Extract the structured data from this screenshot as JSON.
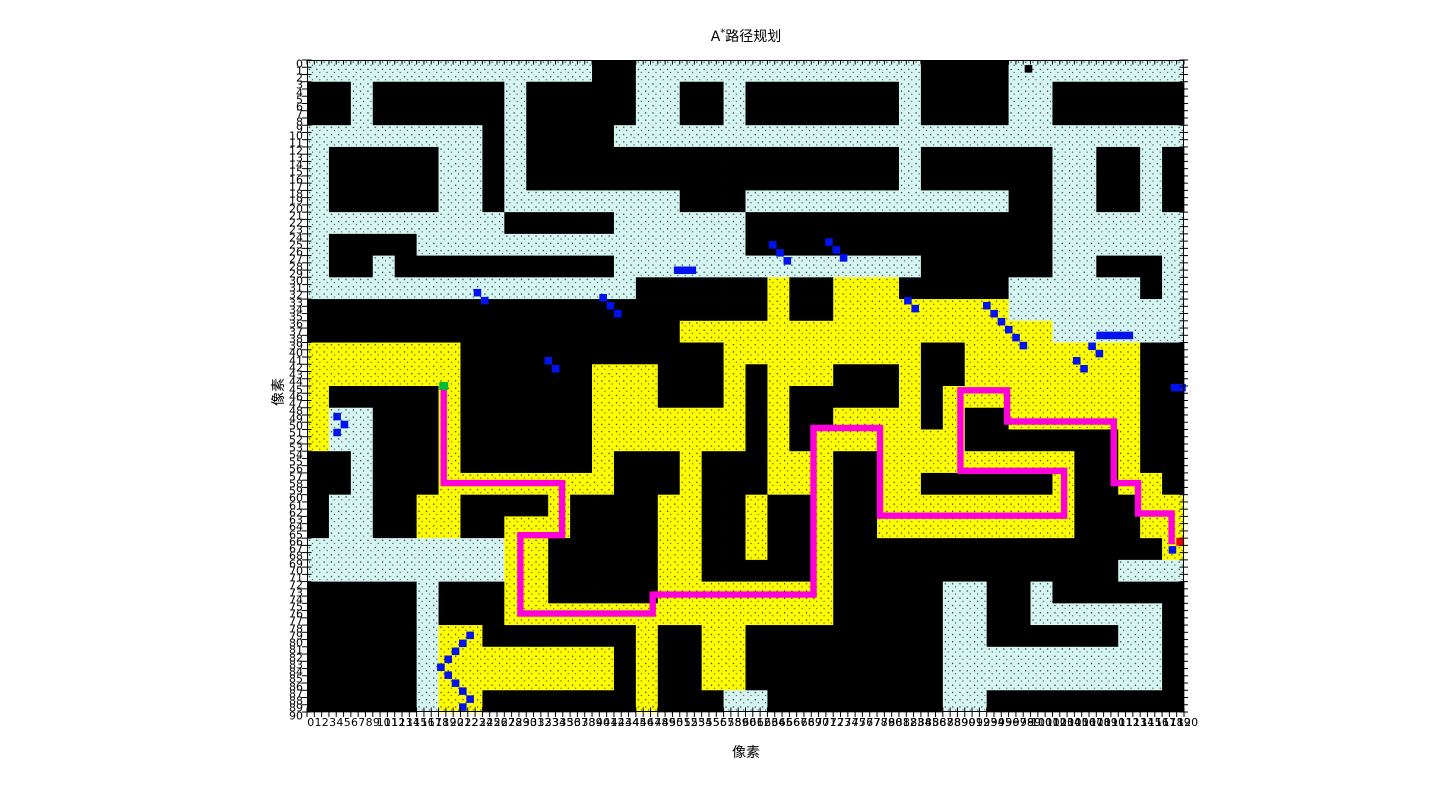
{
  "figure": {
    "title": {
      "prefix": "A",
      "sup": "*",
      "rest": "路径规划"
    },
    "x_axis_label": "像素",
    "y_axis_label": "像素"
  },
  "axes": {
    "x_min": 0,
    "x_max": 120,
    "x_step": 1,
    "y_min": 0,
    "y_max": 90,
    "y_step": 1
  },
  "chart_data": {
    "type": "heatmap",
    "title": "A*路径规划",
    "xlabel": "像素",
    "ylabel": "像素",
    "x_range": [
      0,
      120
    ],
    "y_range": [
      0,
      90
    ],
    "grid_cols": 120,
    "grid_rows": 90,
    "block_size_cells": 3,
    "cell_types": {
      "#": "obstacle",
      ".": "free-space",
      "Y": "explored-closed-set"
    },
    "colors": {
      "obstacle": "#000000",
      "free": "#d6f6f3",
      "explored": "#ffff00",
      "frontier": "#0013ee",
      "path": "#ff00dd",
      "start": "#00bb33",
      "goal": "#ee0000",
      "background": "#ffffff",
      "dot": "#1a1a1a"
    },
    "block_rows": [
      ".............##.............####........",
      "##.######.#####..##.#######.####..######",
      "##.######.#####..##.#######.####..######",
      "........#.####..........................",
      ".#####..#.#################.######..##.#",
      ".#####..#.#################.######..##.#",
      ".#####..#........###............##..##.#",
      ".........#####......##############......",
      ".####...............##############......",
      ".##.##########..............######..###.",
      "...............######Y##YYY#####......#.",
      "#####################Y##YYYYYYYY........",
      "#################YYYYYYYYYYYYYYYYY......",
      "YYYYYYY############YYYYYYYYY##YYYYYYYY##",
      "YYYYYYY######YYY###Y#YYY###Y##YYYYYYYY##",
      "Y#####Y######YYY###Y#Y#####Y#YYYYYYYYY##",
      "Y..###Y######YYYYYYY#Y##YYYY#Y##YYYYYY##",
      "Y..###Y######YYYYYYY#Y#YYYYYYY#######Y##",
      "##.###Y######Y###Y###YYY##YYYYYYYYY##Y##",
      "##.###YYYYYYYY###Y###YYY##YY######Y##YY#",
      "#..##YY####Y####YY##Y##Y##YYYYYYYYY###YY",
      "#..##YY##YYY####YY##Y##Y##YYYYYYYYY###YY",
      ".........YY#####YY##Y##Y###############Y",
      ".........YY#####YY#####Y#############...",
      "#####.###YY#####YYYYYYYY#####..##.######",
      "#####.###YYYYYYYYYYYYYYY#####..##......#",
      "#####.YY#######Y##YY#########..######..#",
      "#####.YYYYYYYY#Y##YY#########..........#",
      "#####.YYYYYYYY#Y##YY#########..........#",
      "#####.YY#######Y###..########..#########"
    ],
    "path_polyline_cells": [
      [
        18.7,
        45.6
      ],
      [
        18.7,
        58.4
      ],
      [
        34.9,
        58.4
      ],
      [
        34.9,
        65.6
      ],
      [
        29.2,
        65.6
      ],
      [
        29.2,
        76.4
      ],
      [
        47.3,
        76.4
      ],
      [
        47.3,
        73.8
      ],
      [
        69.3,
        73.8
      ],
      [
        69.3,
        50.8
      ],
      [
        78.4,
        50.8
      ],
      [
        78.4,
        62.9
      ],
      [
        103.6,
        62.9
      ],
      [
        103.6,
        56.7
      ],
      [
        89.4,
        56.7
      ],
      [
        89.4,
        45.6
      ],
      [
        95.8,
        45.6
      ],
      [
        95.8,
        49.9
      ],
      [
        110.4,
        49.9
      ],
      [
        110.4,
        58.4
      ],
      [
        113.7,
        58.4
      ],
      [
        113.7,
        62.6
      ],
      [
        118.3,
        62.6
      ],
      [
        118.3,
        66.4
      ]
    ],
    "frontier_cells": [
      [
        22.8,
        31.6
      ],
      [
        23.8,
        32.7
      ],
      [
        40.0,
        32.3
      ],
      [
        41.0,
        33.4
      ],
      [
        42.0,
        34.5
      ],
      [
        32.5,
        41.0
      ],
      [
        33.5,
        42.1
      ],
      [
        3.6,
        48.7
      ],
      [
        4.6,
        49.8
      ],
      [
        3.6,
        50.9
      ],
      [
        63.2,
        25.0
      ],
      [
        64.2,
        26.1
      ],
      [
        65.2,
        27.2
      ],
      [
        70.9,
        24.6
      ],
      [
        71.9,
        25.7
      ],
      [
        72.9,
        26.8
      ],
      [
        50.2,
        28.5
      ],
      [
        51.2,
        28.5
      ],
      [
        52.2,
        28.5
      ],
      [
        81.7,
        32.7
      ],
      [
        82.7,
        33.8
      ],
      [
        92.5,
        33.4
      ],
      [
        93.5,
        34.5
      ],
      [
        94.5,
        35.6
      ],
      [
        95.5,
        36.7
      ],
      [
        96.5,
        37.8
      ],
      [
        97.5,
        38.9
      ],
      [
        104.8,
        41.0
      ],
      [
        105.8,
        42.1
      ],
      [
        106.9,
        39.0
      ],
      [
        107.9,
        40.0
      ],
      [
        108.0,
        37.5
      ],
      [
        109.0,
        37.5
      ],
      [
        110.0,
        37.5
      ],
      [
        111.0,
        37.5
      ],
      [
        112.0,
        37.5
      ],
      [
        118.2,
        44.7
      ],
      [
        119.2,
        44.7
      ],
      [
        117.9,
        67.1
      ],
      [
        21.8,
        78.9
      ],
      [
        20.8,
        80.0
      ],
      [
        19.8,
        81.1
      ],
      [
        18.8,
        82.2
      ],
      [
        17.8,
        83.3
      ],
      [
        18.8,
        84.4
      ],
      [
        19.8,
        85.5
      ],
      [
        20.8,
        86.6
      ],
      [
        21.8,
        87.7
      ],
      [
        20.8,
        88.8
      ]
    ],
    "obstacle_dot_cells": [
      [
        98.2,
        0.7
      ]
    ],
    "start_cell_center": [
      18.7,
      45.0
    ],
    "goal_cell_center": [
      119.5,
      66.5
    ]
  }
}
